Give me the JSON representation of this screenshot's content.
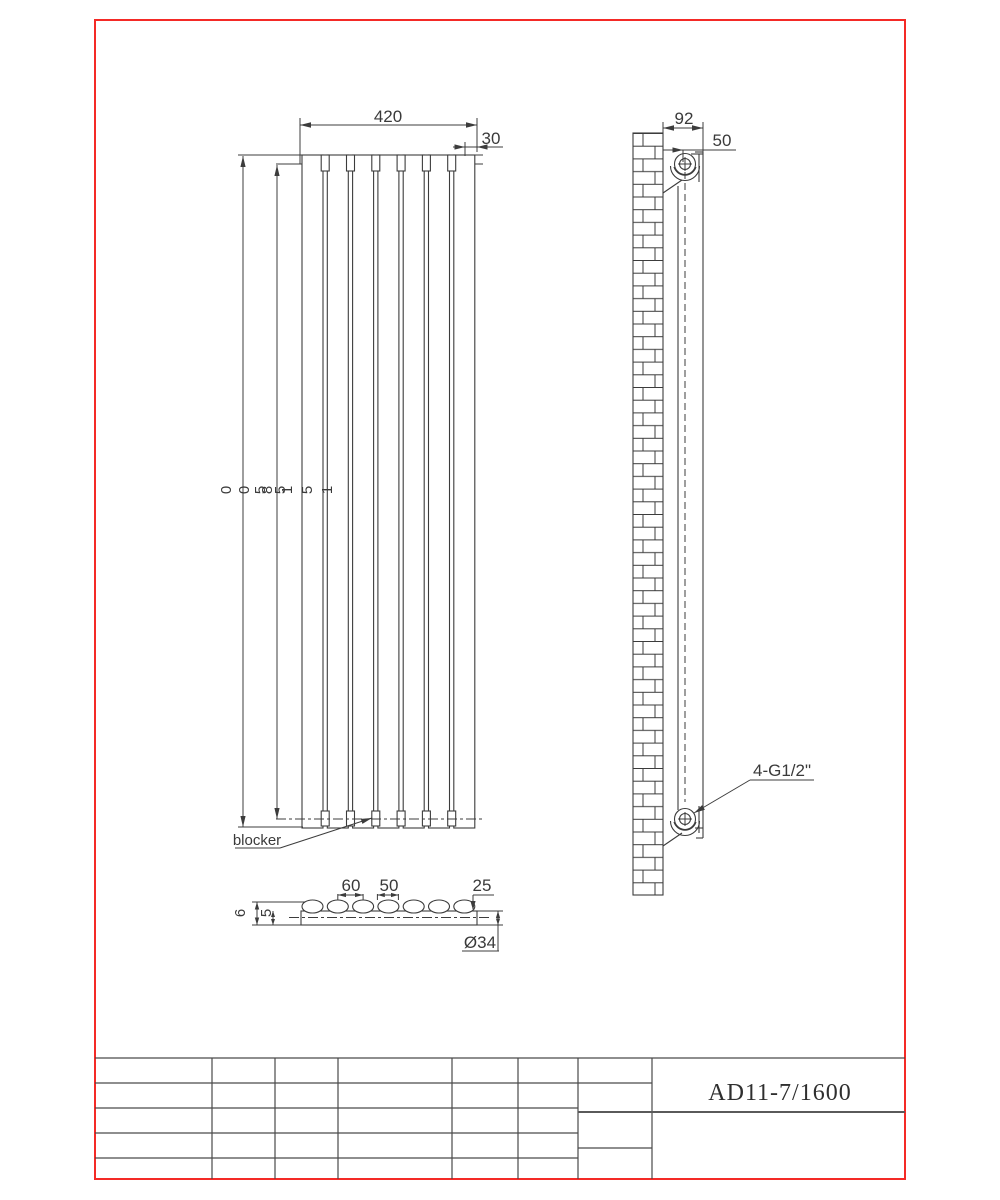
{
  "page": {
    "background": "#ffffff",
    "border_color": "#f42a26",
    "line_color": "#3c3c3c"
  },
  "front_view": {
    "width_dim": "420",
    "offset_dim": "30",
    "left_dim_chars": [
      "0",
      "0",
      "5",
      "8",
      "5",
      "1",
      "5",
      "1"
    ],
    "blocker_label": "blocker"
  },
  "side_view": {
    "depth_dim": "92",
    "center_dim": "50",
    "connection_label": "4-G1/2\""
  },
  "section_view": {
    "pitch_dim": "60",
    "tube_dim": "50",
    "end_dim": "25",
    "height_dim": "6",
    "thickness_dim": "5",
    "collector_dim": "Ø34"
  },
  "title_block": {
    "model": "AD11-7/1600"
  }
}
